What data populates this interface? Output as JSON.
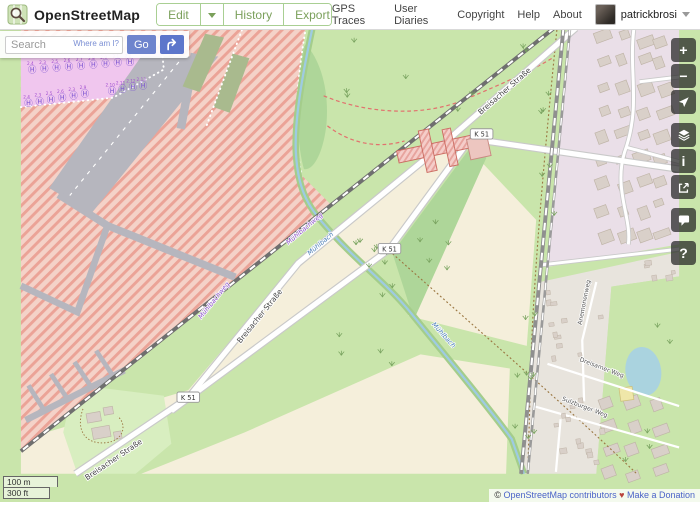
{
  "header": {
    "brand": "OpenStreetMap",
    "nav": [
      {
        "label": "Edit"
      },
      {
        "label": "History"
      },
      {
        "label": "Export"
      }
    ],
    "links": [
      "GPS Traces",
      "User Diaries",
      "Copyright",
      "Help",
      "About"
    ],
    "user": {
      "name": "patrickbrosi"
    }
  },
  "search": {
    "placeholder": "Search",
    "where_am_i": "Where am I?",
    "go": "Go"
  },
  "controls": {
    "zoom_in": "+",
    "zoom_out": "−",
    "info": "i",
    "help": "?"
  },
  "scale": {
    "metric": "100 m",
    "imperial": "300 ft"
  },
  "attribution": {
    "copyright": "©",
    "osm_link": "OpenStreetMap contributors",
    "heart": "♥",
    "donate": "Make a Donation"
  },
  "map": {
    "road_badges": [
      {
        "text": "K 51",
        "x": 490,
        "y": 141
      },
      {
        "text": "K 51",
        "x": 392,
        "y": 263
      },
      {
        "text": "K 51",
        "x": 178,
        "y": 421
      }
    ],
    "street_labels": [
      {
        "text": "Breisacher Straße",
        "x": 516,
        "y": 97,
        "rot": -41,
        "cls": "lbl-street"
      },
      {
        "text": "Breisacher Straße",
        "x": 256,
        "y": 336,
        "rot": -51,
        "cls": "lbl-street"
      },
      {
        "text": "Breisacher Straße",
        "x": 100,
        "y": 489,
        "rot": -34,
        "cls": "lbl-street"
      },
      {
        "text": "Anemonenweg",
        "x": 601,
        "y": 320,
        "rot": -79,
        "cls": "lbl-street-small"
      },
      {
        "text": "Dreisamer Weg",
        "x": 617,
        "y": 391,
        "rot": 21,
        "cls": "lbl-street-small"
      },
      {
        "text": "Sulzburger Weg",
        "x": 599,
        "y": 433,
        "rot": 21,
        "cls": "lbl-street-small"
      }
    ],
    "path_labels": [
      {
        "text": "Mühlbachweg",
        "x": 303,
        "y": 243,
        "rot": -40
      },
      {
        "text": "Mühlbachweg",
        "x": 207,
        "y": 319,
        "rot": -51
      }
    ],
    "water_labels": [
      {
        "text": "Mühlbach",
        "x": 320,
        "y": 259,
        "rot": -40
      },
      {
        "text": "Mühlbach",
        "x": 448,
        "y": 356,
        "rot": 48
      }
    ],
    "helipads": [
      {
        "x": 12,
        "y": 72,
        "n": "2.4"
      },
      {
        "x": 25,
        "y": 71,
        "n": "2.3"
      },
      {
        "x": 38,
        "y": 70,
        "n": "2.5"
      },
      {
        "x": 51,
        "y": 69,
        "n": "2.6"
      },
      {
        "x": 64,
        "y": 68,
        "n": "2.7"
      },
      {
        "x": 77,
        "y": 67,
        "n": "2.8"
      },
      {
        "x": 90,
        "y": 66,
        "n": "2.9"
      },
      {
        "x": 103,
        "y": 65,
        "n": "2.1"
      },
      {
        "x": 116,
        "y": 64,
        "n": "2.2"
      },
      {
        "x": 97,
        "y": 95,
        "n": "2.10"
      },
      {
        "x": 108,
        "y": 93,
        "n": "2.11"
      },
      {
        "x": 119,
        "y": 91,
        "n": "2.12"
      },
      {
        "x": 130,
        "y": 89,
        "n": "2.13"
      },
      {
        "x": 8,
        "y": 108,
        "n": "2.4"
      },
      {
        "x": 20,
        "y": 106,
        "n": "2.3"
      },
      {
        "x": 32,
        "y": 104,
        "n": "2.5"
      },
      {
        "x": 44,
        "y": 102,
        "n": "2.6"
      },
      {
        "x": 56,
        "y": 100,
        "n": "2.3"
      },
      {
        "x": 68,
        "y": 98,
        "n": "2.9"
      }
    ]
  }
}
